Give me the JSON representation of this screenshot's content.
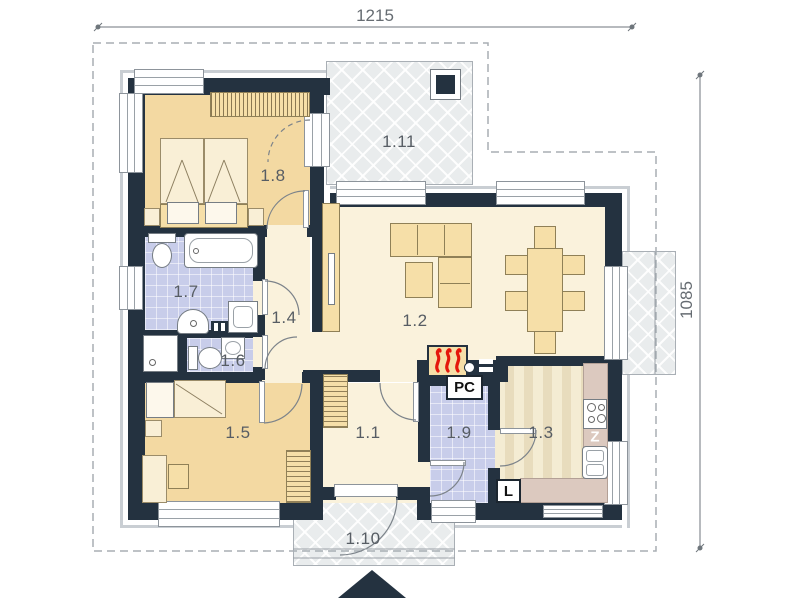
{
  "plan": {
    "dimensions": {
      "width_cm": "1215",
      "height_cm": "1085"
    },
    "rooms": [
      {
        "label": "1.1"
      },
      {
        "label": "1.2"
      },
      {
        "label": "1.3"
      },
      {
        "label": "1.4"
      },
      {
        "label": "1.5"
      },
      {
        "label": "1.6"
      },
      {
        "label": "1.7"
      },
      {
        "label": "1.8"
      },
      {
        "label": "1.9"
      },
      {
        "label": "1.10"
      },
      {
        "label": "1.11"
      }
    ],
    "appliances": {
      "boiler_label": "PC",
      "fridge_label": "L",
      "dishwasher_label": "Z"
    },
    "colors": {
      "wall": "#243240",
      "bedroom_floor": "#f3d9a2",
      "living_floor": "#faf2dc",
      "tile_floor": "#c8cdea",
      "kitchen_board_light": "#f4ecd3",
      "kitchen_board_dark": "#e8dcbd",
      "counter": "#dcc9bf",
      "terrace": "#e9eced",
      "furniture": "#f6dfa8",
      "flame": "#e5170b",
      "dimension_text": "#666c72"
    }
  }
}
